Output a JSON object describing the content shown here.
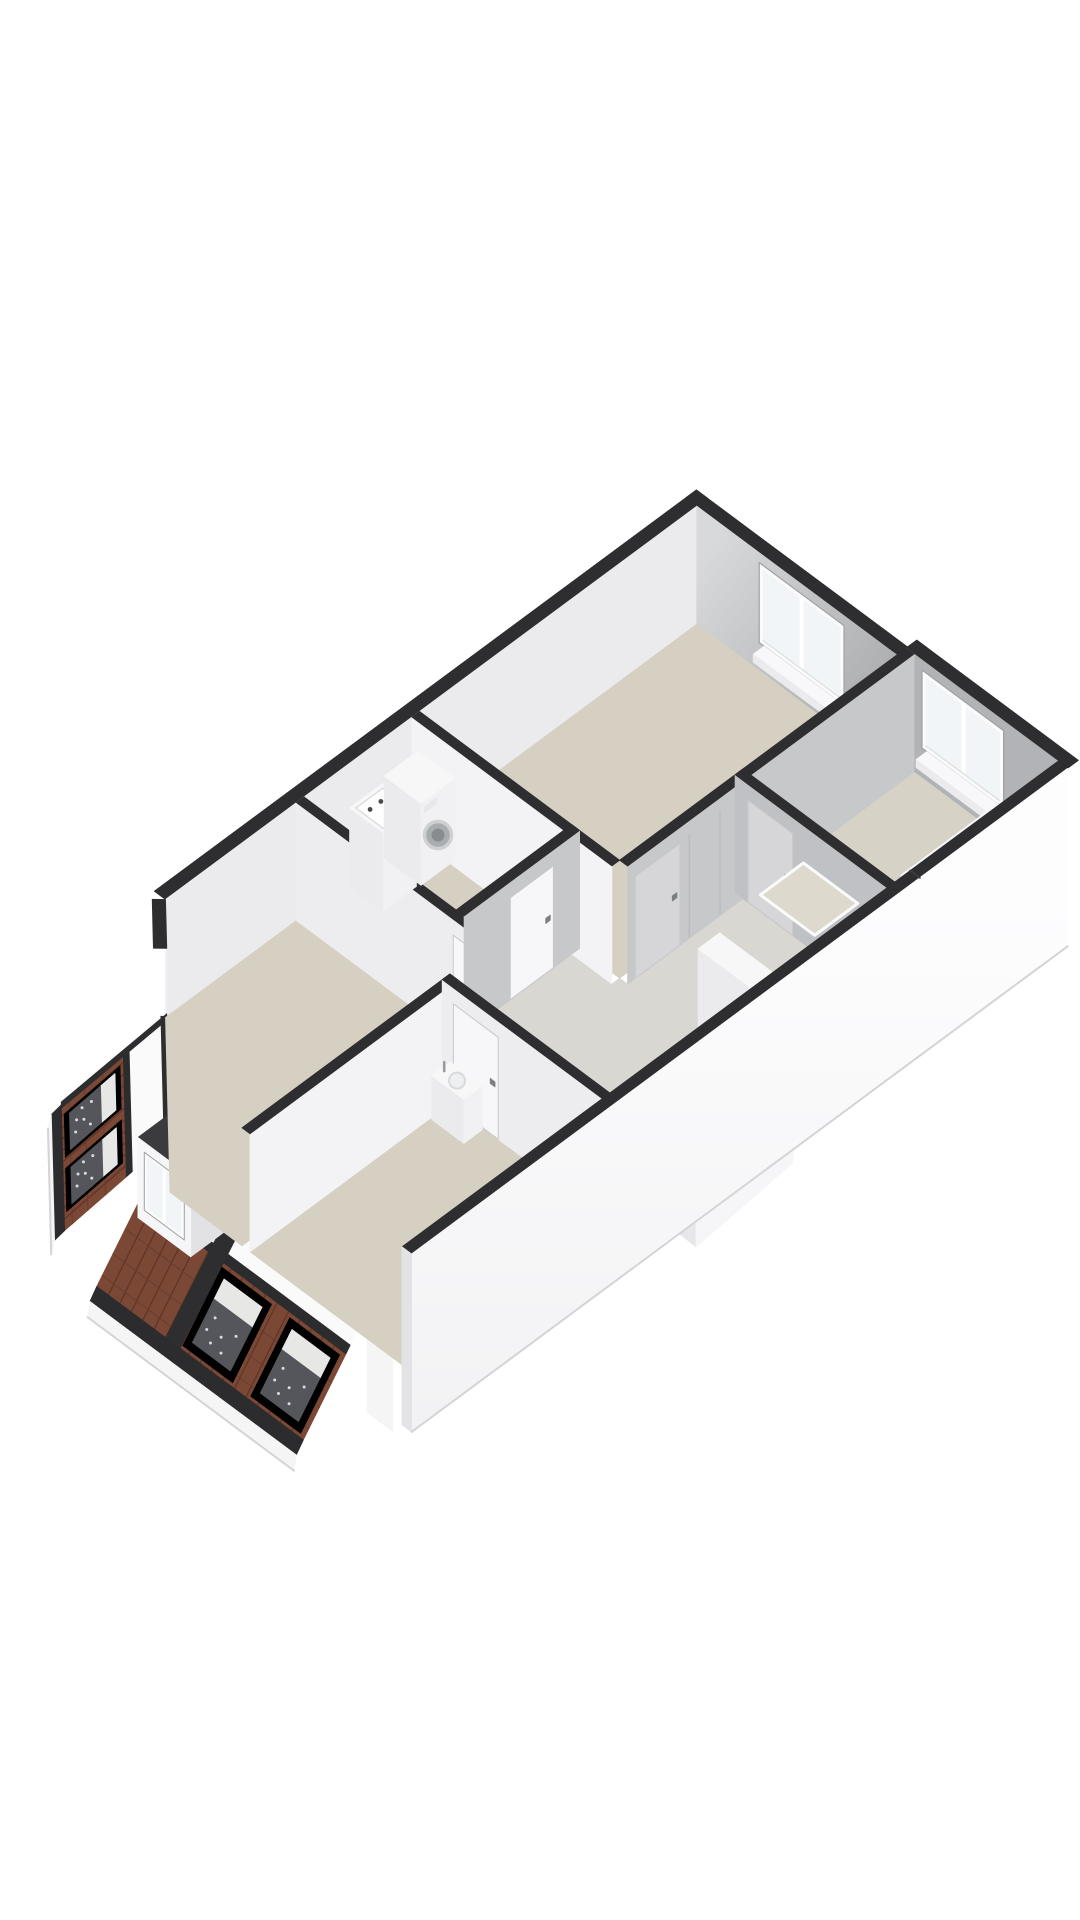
{
  "scene": {
    "kind": "axonometric-3d-floor-plan",
    "background": "#ffffff",
    "floor_shown": "attic-floor-with-cutaway-walls"
  },
  "palette": {
    "wall_top": "#2e2e30",
    "nw_inner": "#ebebed",
    "chamfer_outer": "#f2f2f4",
    "ne_inner_light": "#d8d9db",
    "ne_inner_dark": "#a8a9ac",
    "ne_jog": "#b2b3b6",
    "face_white": "#f3f3f5",
    "face_soft": "#ededef",
    "face_gray": "#c7c8ca",
    "face_dim": "#c0c1c4",
    "door_panel": "#f7f7f9",
    "door_panel_gray": "#d6d6d9",
    "handle": "#7d7e81",
    "seam": "#b9b9bc",
    "floor_beige": "#d5d0c2",
    "floor_hall": "#d8d7d1",
    "floor_bath": "#d6d2c6",
    "tray": "#ddd9cc",
    "glass": "#f2f5f7",
    "frame_white": "#fbfbfc",
    "reveal_shadow": "#a0a1a4",
    "sill_white": "#f8f8fa",
    "roof_tile": "#7c4836",
    "roof_tile_line": "#5e3529",
    "roof_row_line": "#6b3c2d",
    "eave_dark": "#2c2c2e",
    "fascia": "#f5f5f6",
    "slab_side": "#e3e3e5",
    "slope_white": "#fafafb",
    "skylight_glass": "#54565b",
    "skylight_glass_top": "#e7e7e5",
    "skylight_dot": "#d9dadc",
    "dormer_face": "#f6f6f8",
    "dormer_top": "#3b3b3e",
    "dormer_side": "#e2e2e4",
    "fixture_top": "#f7f7f8",
    "fixture_front": "#f1f1f3",
    "fixture_side": "#ebebed",
    "basin": "#edeff0",
    "basin_shadow": "#d7dadb",
    "metal": "#97989b",
    "washer_ring": "#cfd0d2",
    "washer_drum": "#a9adb0",
    "washer_drum_in": "#878c90",
    "stair_well": "#46464a",
    "stair_tread": "#f1f1f3",
    "stair_riser": "#e2e2e4",
    "wedge_light": "#f6f6f8",
    "wedge_shade": "#e7e7e9",
    "under_edge": "#d4d4d6",
    "se_outer": "#fbfbfd"
  },
  "projection": {
    "origin": [
      50,
      1103
    ],
    "eu": [
      0.77,
      -0.57
    ],
    "ev": [
      0.8,
      0.595
    ],
    "wall_height": 118,
    "slab_depth": 60
  },
  "layout": {
    "chamfer": {
      "from": [
        150,
        0
      ],
      "to": [
        0,
        150
      ],
      "tall_until": 0.28
    },
    "nw_band": {
      "u": [
        150,
        854
      ],
      "v": [
        -14,
        0
      ]
    },
    "ne_wall": {
      "u_main": 840,
      "v_main": [
        0,
        250
      ],
      "u_jog": 852,
      "v_jog": [
        250,
        440
      ],
      "band_th": 14
    },
    "se_wall": {
      "v": 440,
      "th": 12,
      "u": [
        0,
        852
      ]
    },
    "low_wall_sw": {
      "v": [
        408,
        440
      ],
      "th": 12
    },
    "bands": {
      "knee": [
        0,
        6
      ],
      "slope": [
        6,
        34
      ],
      "trim": [
        34,
        40
      ],
      "tile": [
        40,
        95
      ],
      "eave": [
        95,
        104
      ],
      "z_knee": 50,
      "z_hi": 20,
      "z_lo": 14,
      "z_eave": -40,
      "z_eave2": -50,
      "z_fascia": -64
    },
    "strip_a": {
      "windows": [
        [
          0.09,
          0.44
        ],
        [
          0.52,
          0.87
        ]
      ]
    },
    "strip_b": {
      "v": [
        150,
        408
      ],
      "windows": [
        [
          0.407,
          0.651
        ],
        [
          0.736,
          0.981
        ]
      ],
      "dormer": {
        "v": [
          158,
          224
        ],
        "depth": 50,
        "z": [
          8,
          88
        ],
        "win_v": [
          166,
          216
        ],
        "win_z": [
          20,
          78
        ]
      }
    },
    "divider_cap": {
      "v": [
        236,
        254
      ]
    },
    "rooms": [
      {
        "name": "bedroom-2",
        "poly": [
          [
            150,
            0
          ],
          [
            320,
            0
          ],
          [
            320,
            240
          ],
          [
            0,
            240
          ],
          [
            0,
            150
          ]
        ],
        "floor": "floor_beige"
      },
      {
        "name": "utility-room",
        "poly": [
          [
            330,
            0
          ],
          [
            470,
            0
          ],
          [
            470,
            190
          ],
          [
            330,
            190
          ]
        ],
        "floor": "floor_beige"
      },
      {
        "name": "bedroom-1",
        "poly": [
          [
            480,
            0
          ],
          [
            840,
            0
          ],
          [
            840,
            250
          ],
          [
            480,
            250
          ]
        ],
        "floor": "floor_beige"
      },
      {
        "name": "bathroom",
        "poly": [
          [
            640,
            260
          ],
          [
            852,
            260
          ],
          [
            852,
            440
          ],
          [
            640,
            440
          ]
        ],
        "floor": "floor_bath"
      },
      {
        "name": "bedroom-3",
        "poly": [
          [
            0,
            250
          ],
          [
            260,
            250
          ],
          [
            260,
            440
          ],
          [
            0,
            440
          ]
        ],
        "floor": "floor_beige"
      },
      {
        "name": "landing",
        "poly": [
          [
            330,
            200
          ],
          [
            470,
            200
          ],
          [
            470,
            250
          ],
          [
            480,
            250
          ],
          [
            480,
            260
          ],
          [
            630,
            260
          ],
          [
            630,
            440
          ],
          [
            270,
            440
          ],
          [
            270,
            250
          ],
          [
            330,
            250
          ]
        ],
        "floor": "floor_hall"
      }
    ],
    "interior_walls": [
      {
        "name": "wall-bedroom1-west",
        "axis": "v",
        "pos": 470,
        "span": [
          0,
          250
        ],
        "face": "face_white"
      },
      {
        "name": "wall-bedroom2-east",
        "axis": "v",
        "pos": 320,
        "span": [
          0,
          240
        ],
        "face": "face_soft",
        "door": {
          "span": [
            196,
            236
          ],
          "panel": "door_panel",
          "handle_at": 230
        }
      },
      {
        "name": "wall-utility-south",
        "axis": "u",
        "pos": 190,
        "span": [
          330,
          480
        ],
        "face": "face_gray",
        "door": {
          "span": [
            390,
            446
          ],
          "panel": "door_panel",
          "handle_at": 440
        }
      },
      {
        "name": "wall-bedrooms-divider",
        "axis": "u",
        "pos": 240,
        "span": [
          0,
          270
        ],
        "face": "face_white"
      },
      {
        "name": "wall-bedroom3-east",
        "axis": "v",
        "pos": 260,
        "span": [
          240,
          440
        ],
        "face": "face_soft",
        "door": {
          "span": [
            254,
            310
          ],
          "panel": "door_panel",
          "handle_at": 304
        }
      },
      {
        "name": "wall-landing-north",
        "axis": "u",
        "pos": 250,
        "span": [
          480,
          852
        ],
        "face": "face_gray",
        "door": {
          "span": [
            490,
            548
          ],
          "panel": "door_panel_gray",
          "handle_at": 542
        },
        "seams": [
          560,
          600,
          640
        ]
      },
      {
        "name": "wall-bathroom-west",
        "axis": "v",
        "pos": 630,
        "span": [
          250,
          440
        ],
        "face": "face_dim",
        "door": {
          "span": [
            266,
            322
          ],
          "panel": "door_panel_gray",
          "handle_at": 316
        }
      }
    ],
    "windows": [
      {
        "name": "window-bedroom-1",
        "wall": "main",
        "v": [
          78,
          184
        ],
        "z": [
          28,
          108
        ],
        "mullion": 131,
        "sill": {
          "u": [
            826,
            840
          ],
          "v": [
            84,
            178
          ],
          "z": [
            20,
            28
          ]
        }
      },
      {
        "name": "window-bathroom",
        "wall": "jog",
        "v": [
          270,
          372
        ],
        "z": [
          30,
          108
        ],
        "mullion": 322,
        "sill": {
          "u": [
            838,
            852
          ],
          "v": [
            276,
            366
          ],
          "z": [
            22,
            30
          ]
        }
      }
    ],
    "fixtures": {
      "utility_sink": {
        "u": [
          385,
          428
        ],
        "v": [
          4,
          46
        ],
        "h": 78,
        "taps": [
          [
            397,
            18
          ],
          [
            411,
            18
          ]
        ]
      },
      "washing_machine": {
        "u": [
          432,
          476
        ],
        "v": [
          2,
          48
        ],
        "h": 82
      },
      "bedroom_sink": {
        "u": [
          234,
          258
        ],
        "v": [
          252,
          292
        ],
        "h": 44
      },
      "bathtub": {
        "u": [
          706,
          836
        ],
        "v": [
          384,
          434
        ],
        "h": 54
      },
      "tub_step": {
        "u": [
          656,
          706
        ],
        "v": [
          384,
          434
        ],
        "h": 34
      },
      "shower_tray": {
        "u": [
          644,
          700
        ],
        "v": [
          268,
          336
        ]
      },
      "towel_bar": {
        "u": [
          712,
          796
        ],
        "v": 430,
        "z": 58
      },
      "stairs": {
        "open": [
          [
            505,
            355
          ],
          [
            630,
            440
          ]
        ],
        "treads": 3,
        "newel": {
          "u": [
            478,
            506
          ],
          "v": [
            350,
            440
          ],
          "h": 90
        }
      }
    },
    "se_dormer_wedge": {
      "shade": [
        [
          600,
          1116
        ],
        [
          696,
          1193
        ],
        [
          696,
          1247
        ],
        [
          600,
          1170
        ]
      ],
      "light": [
        [
          696,
          1193
        ],
        [
          793,
          1116
        ],
        [
          793,
          1163
        ],
        [
          696,
          1247
        ]
      ]
    }
  }
}
